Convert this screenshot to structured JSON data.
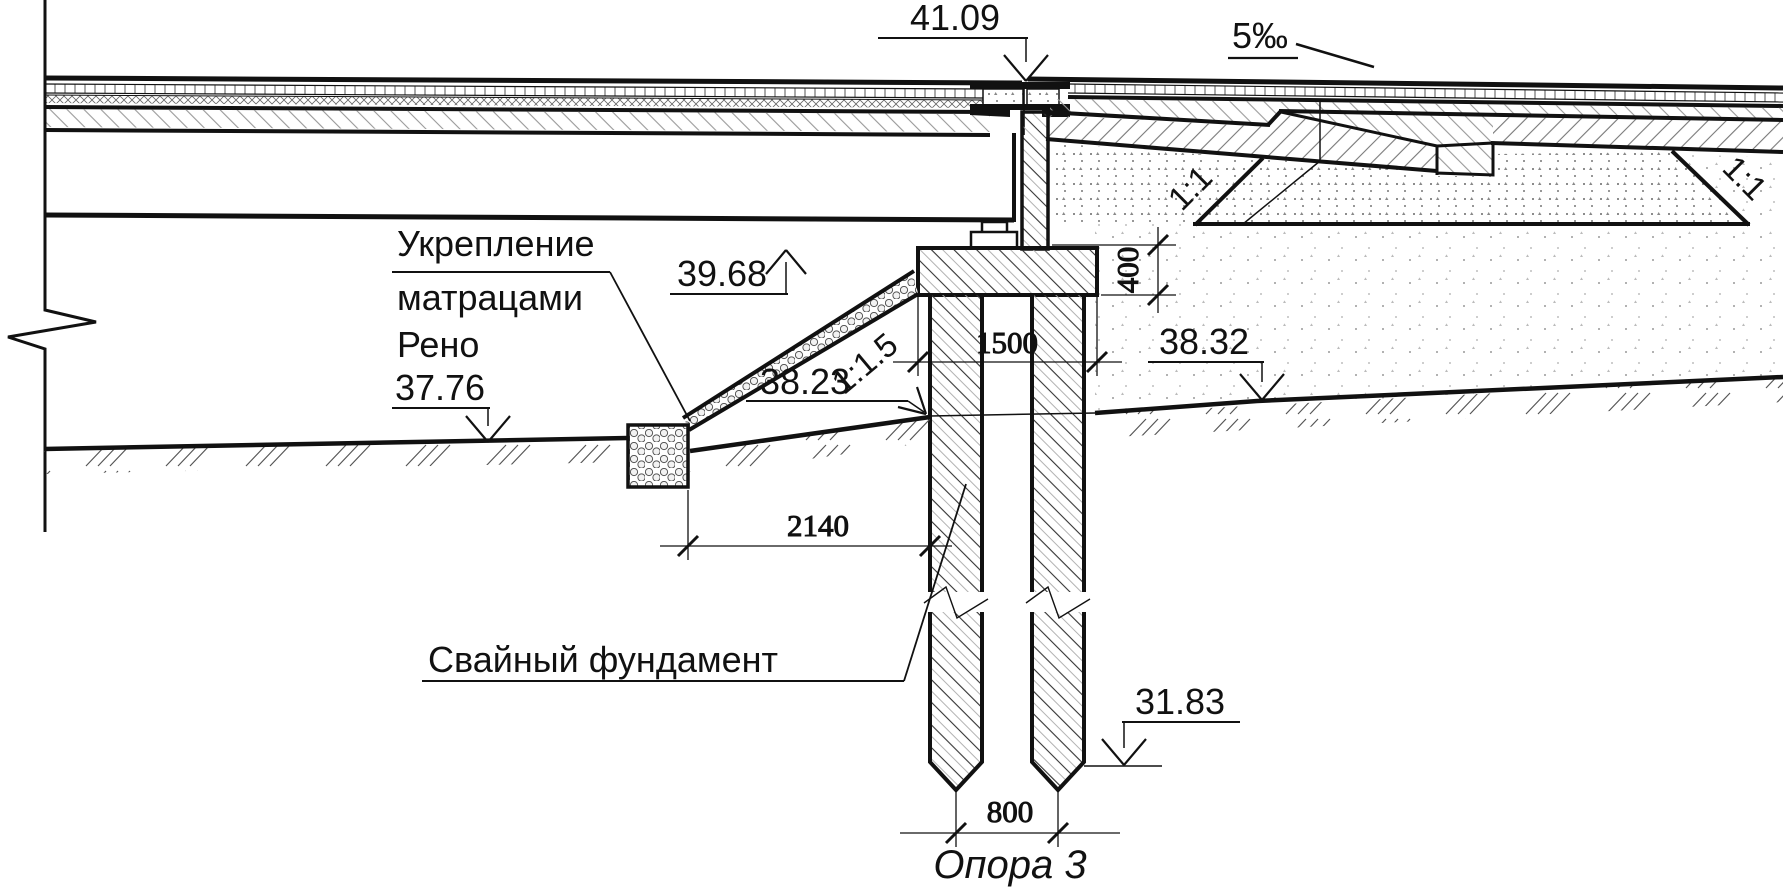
{
  "drawing": {
    "title": "Опора 3",
    "line_color": "#111111",
    "labels": {
      "reinforcement_line1": "Укрепление",
      "reinforcement_line2": "матрацами",
      "reinforcement_line3": "Рено",
      "pile_foundation": "Свайный  фундамент"
    },
    "elevations": {
      "deck_joint": "41.09",
      "cap_top": "39.68",
      "ground_left": "37.76",
      "slope_toe": "38.23",
      "ground_right": "38.32",
      "pile_tip": "31.83"
    },
    "dimensions": {
      "cap_width": "1500",
      "cap_height": "400",
      "berm_width": "2140",
      "pile_spacing": "800"
    },
    "slopes": {
      "roadway": "5‰",
      "cone_left": "1:1",
      "cone_right": "1:1",
      "riverbank": "1:1.5"
    }
  }
}
